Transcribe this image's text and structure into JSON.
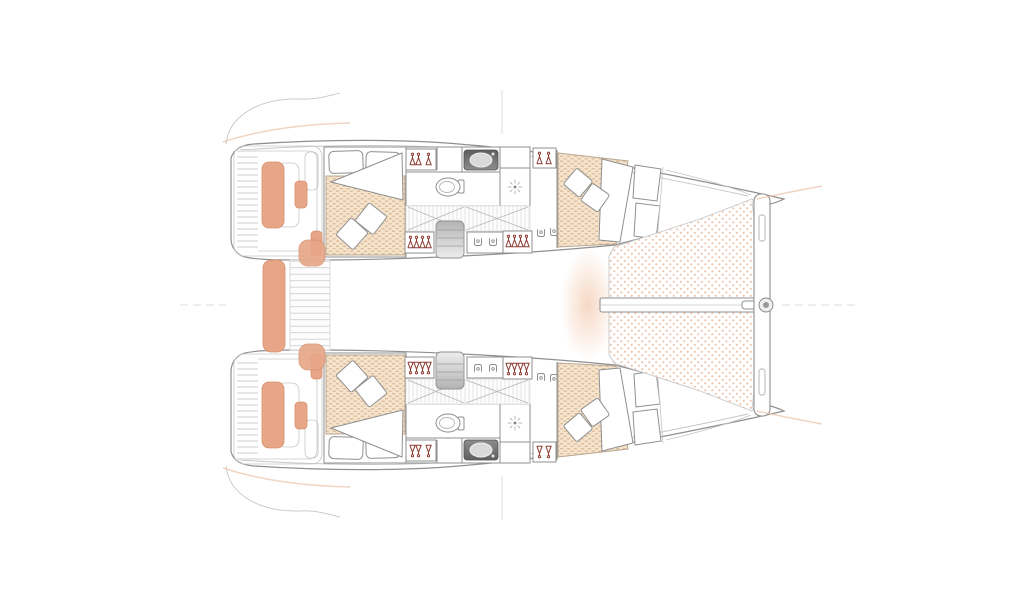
{
  "page": {
    "title": "Catamaran interior layout floor plan",
    "background": "#ffffff"
  },
  "colors": {
    "outline": "#8f8f8f",
    "outline_light": "#c6c6c6",
    "accent_line": "#e9c6ae",
    "cushion": "#e7a687",
    "cushion_edge": "#d6916f",
    "mattress_base": "#f5e3cc",
    "mattress_line": "#ddbc99",
    "mattress_edge": "#b9a893",
    "tramp_dot": "#eec5ae",
    "hanger": "#8e3c33",
    "glow": "#f0b894"
  },
  "plan": {
    "type": "floor-plan",
    "subject": "catamaran yacht accommodation deck",
    "orientation": "bow-right",
    "hulls": [
      {
        "id": "port-hull",
        "position": "top",
        "rooms": [
          {
            "name": "aft-double-cabin",
            "furniture": [
              "double-berth",
              "head-pillows",
              "throw-pillows",
              "folded-sheet"
            ]
          },
          {
            "name": "bathroom",
            "fixtures": [
              "washbasin",
              "toilet",
              "shower"
            ]
          },
          {
            "name": "passageway",
            "fixtures": [
              "door-swings",
              "companionway-steps",
              "wardrobe-hangers",
              "shelf-storage"
            ]
          },
          {
            "name": "forward-double-cabin",
            "furniture": [
              "angled-double-berth",
              "throw-pillows",
              "seat-panels",
              "wardrobe-hangers"
            ]
          }
        ]
      },
      {
        "id": "starboard-hull",
        "position": "bottom",
        "rooms": [
          {
            "name": "aft-double-cabin",
            "furniture": [
              "double-berth",
              "head-pillows",
              "throw-pillows",
              "folded-sheet"
            ]
          },
          {
            "name": "bathroom",
            "fixtures": [
              "washbasin",
              "toilet",
              "shower"
            ]
          },
          {
            "name": "passageway",
            "fixtures": [
              "door-swings",
              "companionway-steps",
              "wardrobe-hangers",
              "shelf-storage"
            ]
          },
          {
            "name": "forward-double-cabin",
            "furniture": [
              "angled-double-berth",
              "throw-pillows",
              "seat-panels",
              "wardrobe-hangers"
            ]
          }
        ]
      }
    ],
    "bow": {
      "features": [
        "trampoline-net-port",
        "trampoline-net-starboard",
        "longitudinal-beam",
        "forward-crossbeam",
        "forestay-fitting",
        "mooring-lines"
      ]
    },
    "stern": {
      "features": [
        "transom-platform-port",
        "transom-platform-starboard",
        "deck-hatches",
        "cockpit-bench-cushions",
        "cockpit-steps"
      ]
    },
    "reference_marks": [
      "mast-centerline-tick-top",
      "mast-centerline-tick-bottom",
      "axis-dashes-bow",
      "axis-dashes-stern"
    ]
  }
}
